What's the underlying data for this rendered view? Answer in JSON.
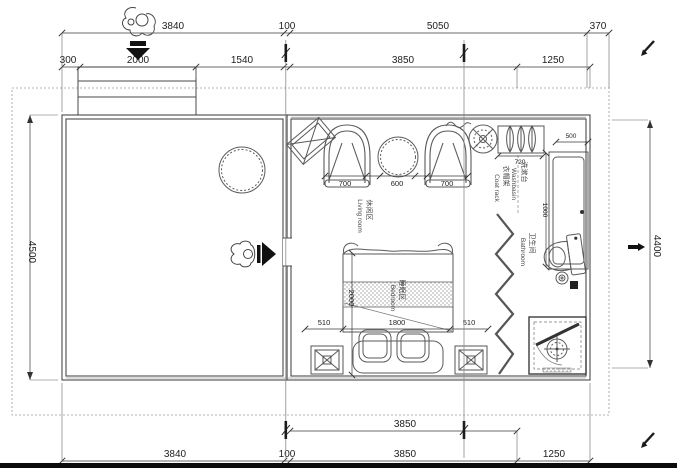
{
  "colors": {
    "ink": "#3f3f3f",
    "background": "#ffffff",
    "marker": "#111111"
  },
  "dims": {
    "t1_3840": "3840",
    "t1_100": "100",
    "t1_5050": "5050",
    "t1_370": "370",
    "t2_300": "300",
    "t2_2000": "2000",
    "t2_1540": "1540",
    "t2_3850": "3850",
    "t2_1250": "1250",
    "left_4500": "4500",
    "right_4400": "4400",
    "b1_3850": "3850",
    "b2_3840": "3840",
    "b2_100": "100",
    "b2_3850": "3850",
    "b2_1250": "1250",
    "lv_700a": "700",
    "lv_600": "600",
    "lv_700b": "700",
    "coat_720": "720",
    "wb_500": "500",
    "wb_1000": "1000",
    "bed_510l": "510",
    "bed_1800": "1800",
    "bed_510r": "510",
    "bed_2000": "2000"
  },
  "rooms": {
    "living_zh": "休闲区",
    "living_en": "Living room",
    "bedroom_zh": "睡眠区",
    "bedroom_en": "Bedroom",
    "bathroom_zh": "卫生间",
    "bathroom_en": "Bathroom",
    "washbasin_zh": "洗漱台",
    "washbasin_en": "Washbasin",
    "coatrack_zh": "衣帽架",
    "coatrack_en": "Coat rack"
  }
}
